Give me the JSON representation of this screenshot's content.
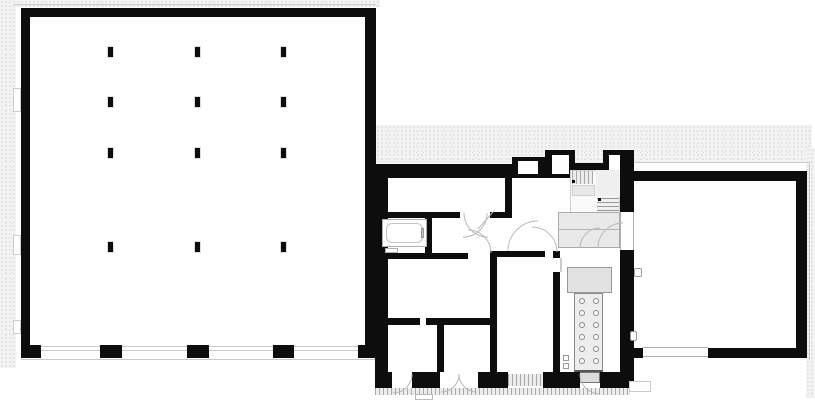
{
  "canvas": {
    "width": 815,
    "height": 400,
    "background": "#ffffff"
  },
  "drawing": {
    "kind": "architectural floor plan",
    "text_labels": [],
    "wings": [
      "left-hall",
      "middle-wing",
      "right-hall"
    ]
  },
  "colors": {
    "wall": "#0d0d0d",
    "line_light": "#c9c9c9",
    "line_mid": "#9a9a9a",
    "fill_light": "#ededed",
    "fill_mid": "#e2e2e2",
    "stipple_bg": "#f3f3f3",
    "stipple_dot": "#c6c6c6"
  },
  "plan": {
    "left_hall": {
      "columns": {
        "x": [
          110,
          197,
          283
        ],
        "y": [
          52,
          102,
          153,
          247
        ],
        "w": 5,
        "h": 10
      },
      "bottom_piers": [
        [
          21,
          20
        ],
        [
          100,
          22
        ],
        [
          187,
          22
        ],
        [
          273,
          21
        ],
        [
          358,
          18
        ]
      ],
      "wall_notches": [
        [
          88,
          24
        ],
        [
          235,
          20
        ],
        [
          320,
          14
        ]
      ]
    },
    "middle_wing": {
      "bottom_piers": [
        [
          375,
          17
        ],
        [
          412,
          28
        ],
        [
          478,
          30
        ],
        [
          543,
          37
        ],
        [
          600,
          20
        ]
      ],
      "bottom_openings": [
        "door",
        "double-door",
        "hatched-window",
        "door"
      ],
      "equipment_circles": {
        "cols": [
          582,
          596
        ],
        "rows": [
          301,
          313,
          325,
          337,
          349,
          361
        ],
        "r": 3
      },
      "stair": {
        "upper_treads": 5,
        "lower_treads": 6
      },
      "features": [
        "bathtub",
        "sink",
        "staircase",
        "vestibule-platform",
        "door-swings",
        "wall-niches"
      ]
    },
    "right_hall": {
      "bottom_window_x": [
        643,
        708
      ],
      "left_wall_window_y": [
        212,
        250
      ],
      "features": [
        "empty-hall",
        "wall-fixtures"
      ]
    }
  }
}
